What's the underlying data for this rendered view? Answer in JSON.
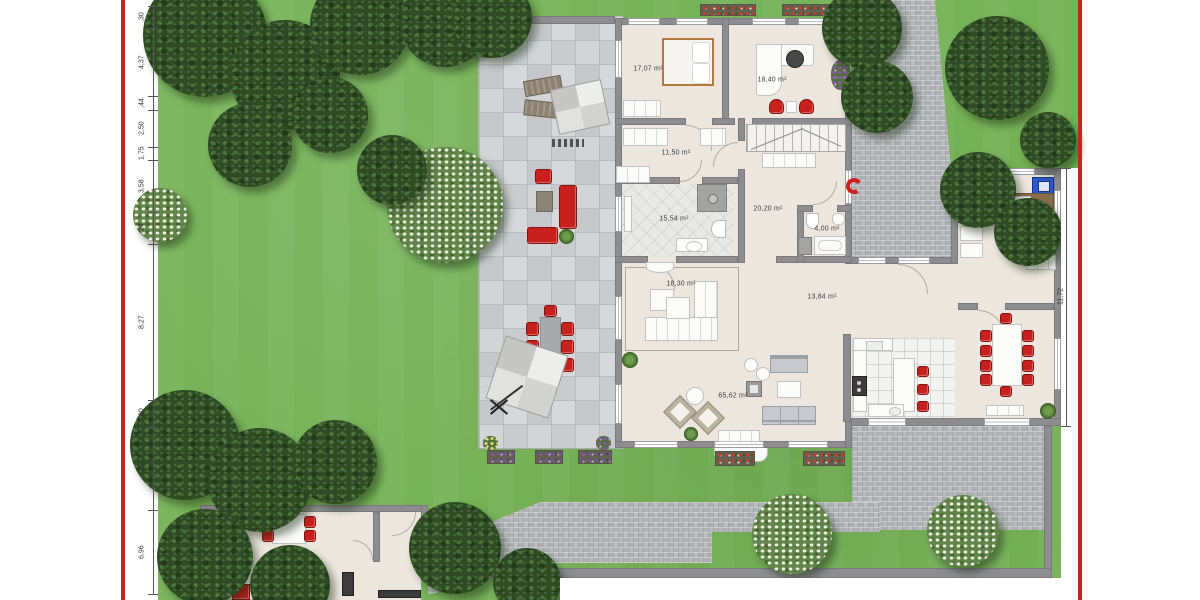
{
  "rooms": [
    {
      "key": "bedroom",
      "area_label": "17,07 m²"
    },
    {
      "key": "office",
      "area_label": "18,40 m²"
    },
    {
      "key": "corridor",
      "area_label": "11,50 m²"
    },
    {
      "key": "bathroom",
      "area_label": "15,54 m²"
    },
    {
      "key": "hall",
      "area_label": "20,20 m²"
    },
    {
      "key": "wc",
      "area_label": "4,00 m²"
    },
    {
      "key": "sitting-area",
      "area_label": "18,30 m²"
    },
    {
      "key": "hallway",
      "area_label": "13,84 m²"
    },
    {
      "key": "living-room",
      "area_label": "65,62 m²"
    }
  ],
  "left_ruler": {
    "labels": [
      ",30",
      "4,37",
      ",44",
      "2,50",
      "1,75",
      "3,58",
      ",24",
      "8,27",
      ",30",
      ",23",
      "6,96"
    ]
  },
  "right_dimension": {
    "label": "11,72"
  },
  "colors": {
    "grass": "#76b257",
    "patio_tile": "#d0d2d5",
    "cobble": "#b3b5b8",
    "wall": "#8d8d91",
    "interior_floor": "#ece6de",
    "accent_red": "#c8201d",
    "page_border_red": "#c4251f",
    "washer_blue": "#2c58c8",
    "bed_frame_wood": "#b5793f"
  }
}
